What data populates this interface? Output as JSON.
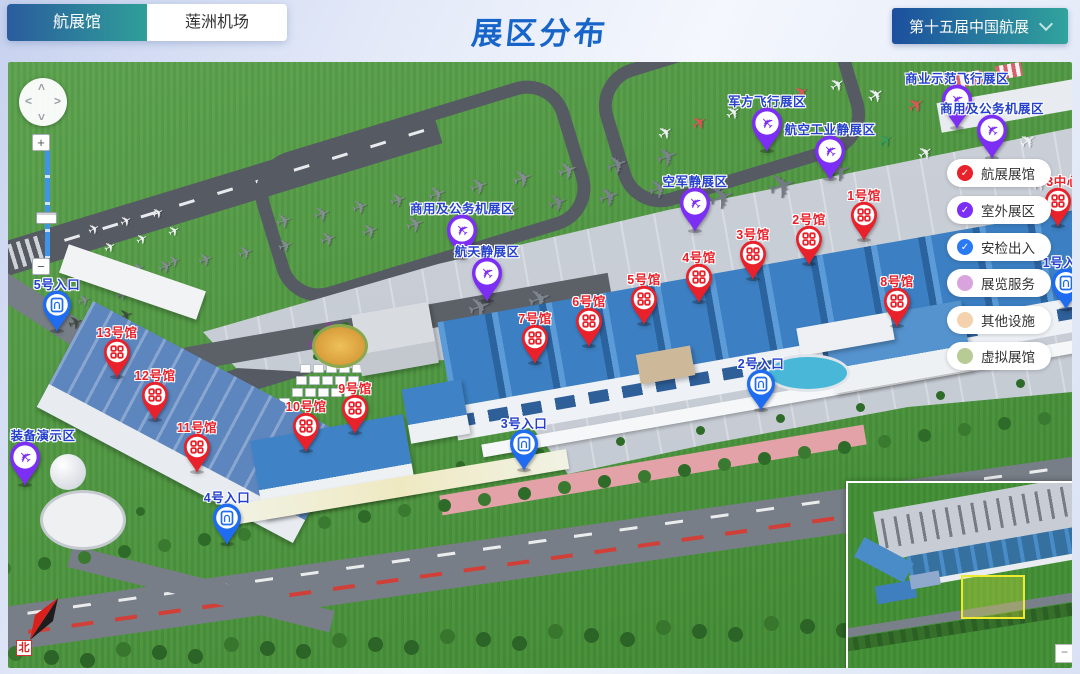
{
  "header": {
    "tabs": [
      {
        "label": "航展馆",
        "active": true
      },
      {
        "label": "莲洲机场",
        "active": false
      }
    ],
    "title": "展区分布",
    "edition_dropdown": {
      "label": "第十五届中国航展"
    }
  },
  "legend": {
    "items": [
      {
        "label": "航展展馆",
        "color": "#e8212a",
        "checked": true
      },
      {
        "label": "室外展区",
        "color": "#7d2ef5",
        "checked": true
      },
      {
        "label": "安检出入",
        "color": "#2979f2",
        "checked": true
      },
      {
        "label": "展览服务",
        "color": "#d9a4de",
        "checked": false
      },
      {
        "label": "其他设施",
        "color": "#f3d2ad",
        "checked": false
      },
      {
        "label": "虚拟展馆",
        "color": "#b7cb95",
        "checked": false
      }
    ]
  },
  "markers": {
    "halls": [
      {
        "label": "1号馆",
        "x": 841,
        "y": 138
      },
      {
        "label": "2号馆",
        "x": 786,
        "y": 162
      },
      {
        "label": "3号馆",
        "x": 730,
        "y": 177
      },
      {
        "label": "4号馆",
        "x": 676,
        "y": 200
      },
      {
        "label": "5号馆",
        "x": 621,
        "y": 222
      },
      {
        "label": "6号馆",
        "x": 566,
        "y": 244
      },
      {
        "label": "7号馆",
        "x": 512,
        "y": 261
      },
      {
        "label": "8号馆",
        "x": 874,
        "y": 224
      },
      {
        "label": "9号馆",
        "x": 332,
        "y": 331
      },
      {
        "label": "10号馆",
        "x": 283,
        "y": 349
      },
      {
        "label": "11号馆",
        "x": 174,
        "y": 370
      },
      {
        "label": "12号馆",
        "x": 132,
        "y": 318
      },
      {
        "label": "13号馆",
        "x": 94,
        "y": 275
      },
      {
        "label": "3中心",
        "x": 1035,
        "y": 124,
        "ldx": 5,
        "behind_legend": true
      }
    ],
    "zones": [
      {
        "label": "军方飞行展区",
        "x": 742,
        "y": 44
      },
      {
        "label": "航空工业静展区",
        "x": 805,
        "y": 72
      },
      {
        "label": "空军静展区",
        "x": 670,
        "y": 124
      },
      {
        "label": "商用及公务机展区",
        "x": 437,
        "y": 151
      },
      {
        "label": "航天静展区",
        "x": 462,
        "y": 194
      },
      {
        "label": "商业示范飞行展区",
        "x": 932,
        "y": 21
      },
      {
        "label": "商用及公务机展区",
        "x": 967,
        "y": 51
      },
      {
        "label": "装备演示区",
        "x": 0,
        "y": 378,
        "ldx": 18
      }
    ],
    "entrances": [
      {
        "label": "5号入口",
        "x": 33,
        "y": 227
      },
      {
        "label": "4号入口",
        "x": 203,
        "y": 440
      },
      {
        "label": "3号入口",
        "x": 500,
        "y": 366
      },
      {
        "label": "2号入口",
        "x": 737,
        "y": 306
      },
      {
        "label": "1号入口",
        "x": 1042,
        "y": 205
      }
    ]
  },
  "controls": {
    "pan_up": "˄",
    "pan_down": "˅",
    "pan_left": "˂",
    "pan_right": "˃",
    "zoom_in": "+",
    "zoom_out": "−",
    "check_mark": "✓"
  },
  "compass": {
    "north": "北"
  },
  "minimap": {
    "collapse": "−"
  },
  "colors": {
    "hall": "#e8212a",
    "zone": "#7d2ef5",
    "entrance": "#1f6cf0"
  }
}
